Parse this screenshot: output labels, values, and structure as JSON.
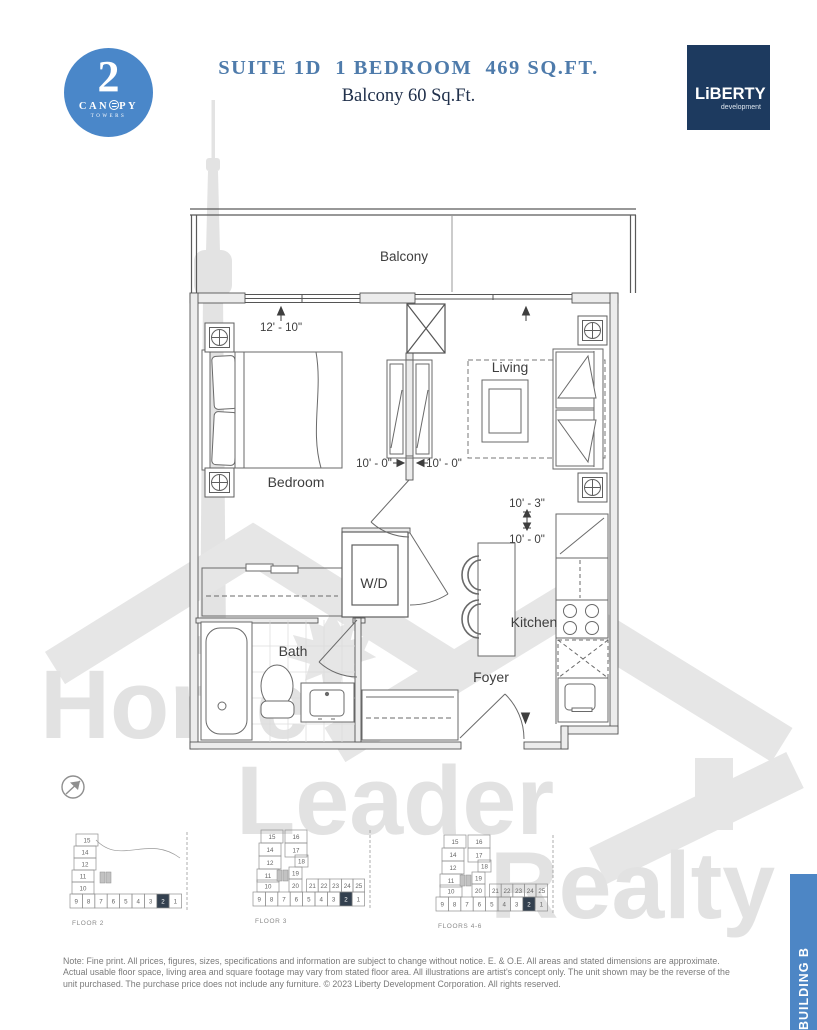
{
  "header": {
    "logo": {
      "number": "2",
      "name_left": "CAN",
      "name_right": "PY",
      "towers": "TOWERS"
    },
    "title": "SUITE 1D  1 BEDROOM  469 SQ.FT.",
    "subtitle": "Balcony 60 Sq.Ft.",
    "developer": {
      "name": "LiBERTY",
      "sub": "development"
    }
  },
  "plan": {
    "rooms": {
      "balcony": "Balcony",
      "bedroom": "Bedroom",
      "living": "Living",
      "wd": "W/D",
      "bath": "Bath",
      "kitchen": "Kitchen",
      "foyer": "Foyer"
    },
    "dimensions": {
      "bedroom_width": "12' - 10\"",
      "hall_left": "10' - 0\"",
      "hall_right": "10' - 0\"",
      "kitchen_depth": "10' - 3\"",
      "kitchen_width": "10' - 0\""
    }
  },
  "watermark": {
    "word1": "Home",
    "word2": "Leader",
    "word3": "Realty"
  },
  "keyplates": [
    {
      "label": "FLOOR 2",
      "type": "A",
      "left_column": [
        "15",
        "14",
        "12",
        "11",
        "10"
      ],
      "bottom_row": [
        "9",
        "8",
        "7",
        "6",
        "5",
        "4",
        "3",
        "2",
        "1"
      ],
      "highlight": "2"
    },
    {
      "label": "FLOOR 3",
      "type": "B",
      "cluster": [
        "15",
        "16",
        "14",
        "17",
        "12",
        "18",
        "11",
        "19",
        "10",
        "20"
      ],
      "mid_row": [
        "21",
        "22",
        "23",
        "24",
        "25"
      ],
      "bottom_row": [
        "9",
        "8",
        "7",
        "6",
        "5",
        "4",
        "3",
        "2",
        "1"
      ],
      "highlight": "2"
    },
    {
      "label": "FLOORS 4-6",
      "type": "B",
      "cluster": [
        "15",
        "16",
        "14",
        "17",
        "12",
        "18",
        "11",
        "19",
        "10",
        "20"
      ],
      "mid_row": [
        "21",
        "22",
        "23",
        "24",
        "25"
      ],
      "bottom_row": [
        "9",
        "8",
        "7",
        "6",
        "5",
        "4",
        "3",
        "2",
        "1"
      ],
      "highlight": "2"
    }
  ],
  "building_label": "BUILDING B",
  "disclaimer": {
    "lines": [
      "Note: Fine print. All prices, figures, sizes, specifications and information are subject to change without notice. E. & O.E. All areas and stated dimensions are approximate.",
      "Actual usable floor space, living area and square footage may vary from stated floor area. All illustrations are artist's concept only. The unit shown may be the reverse of the",
      "unit purchased. The purchase price does not include any furniture. © 2023 Liberty Development Corporation. All rights reserved."
    ]
  },
  "colors": {
    "title_blue": "#4e7bab",
    "canopy_blue": "#4a87c9",
    "liberty_navy": "#1d3a5f",
    "bar_blue": "#4d86c5",
    "highlight_cell": "#33404f",
    "watermark_gray": "#e3e3e3"
  }
}
